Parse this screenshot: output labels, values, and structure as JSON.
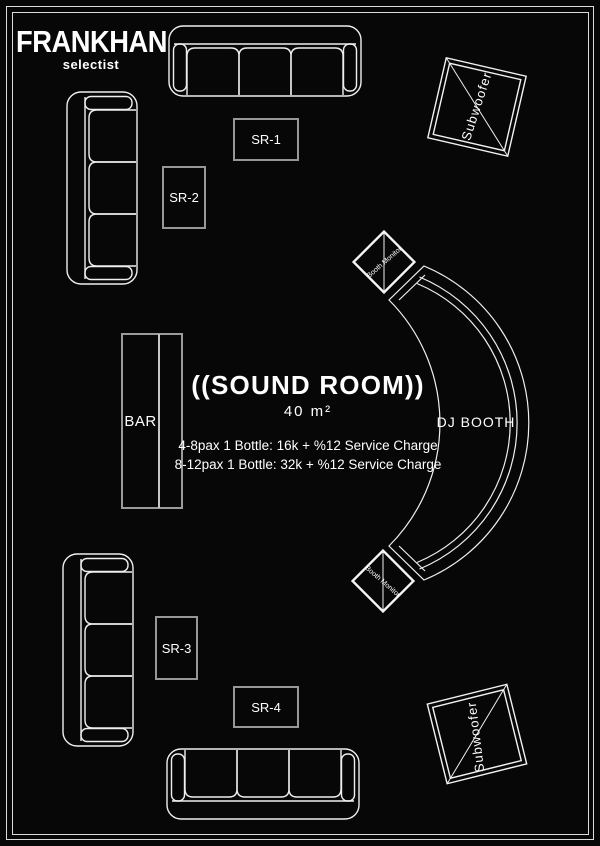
{
  "brand": {
    "name": "FRANKHAN",
    "tagline": "selectist"
  },
  "room": {
    "title": "((SOUND ROOM))",
    "area": "40 m²",
    "pricing": [
      "4-8pax 1 Bottle: 16k + %12 Service Charge",
      "8-12pax 1 Bottle: 32k + %12 Service Charge"
    ]
  },
  "labels": {
    "bar": "BAR",
    "dj_booth": "DJ BOOTH",
    "subwoofer_top": "Subwoofer",
    "subwoofer_bottom": "Subwoofer",
    "booth_monitor_top": "Booth Monitor",
    "booth_monitor_bottom": "Booth Monitor"
  },
  "tables": [
    {
      "id": "SR-1",
      "label": "SR-1"
    },
    {
      "id": "SR-2",
      "label": "SR-2"
    },
    {
      "id": "SR-3",
      "label": "SR-3"
    },
    {
      "id": "SR-4",
      "label": "SR-4"
    }
  ],
  "colors": {
    "background": "#070707",
    "line": "#efefef",
    "table_border": "#979797",
    "text": "#ffffff"
  }
}
